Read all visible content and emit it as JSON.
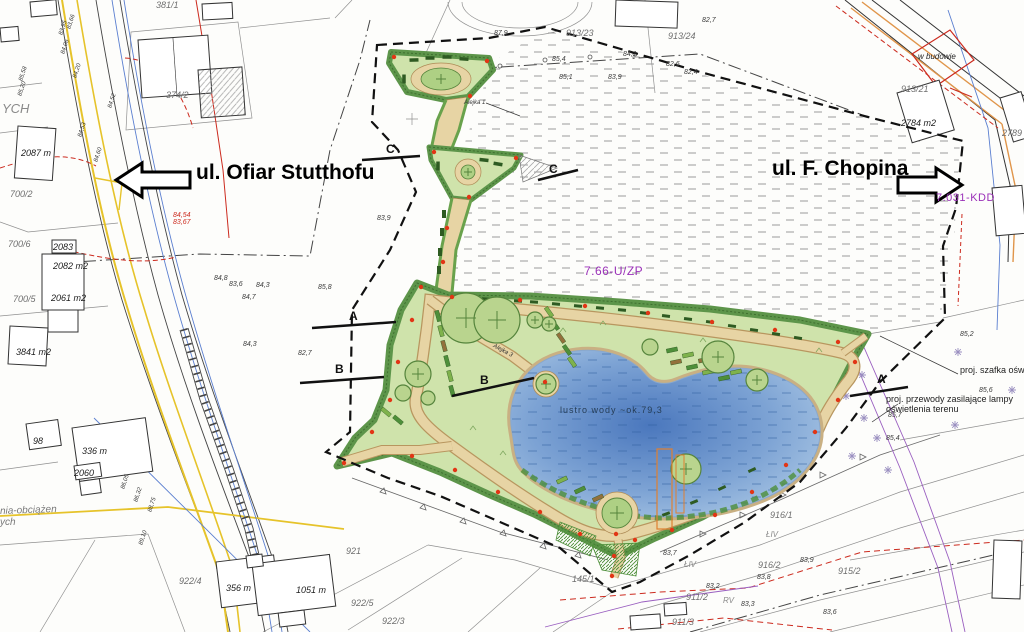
{
  "meta": {
    "type": "landscape-site-plan"
  },
  "streets": {
    "left": {
      "label": "ul. Ofiar Stutthofu"
    },
    "right": {
      "label": "ul. F. Chopina"
    }
  },
  "zones": {
    "park": "7.66-U/ZP",
    "road": "7.031-KDD"
  },
  "pond": {
    "label": "lustro wody ~ok.79,3"
  },
  "annotations": {
    "cabinet": "proj. szafka oświetl",
    "cables1": "proj. przewody zasilające lampy",
    "cables2": "oświetlenia terenu",
    "under_construction": "w budowie",
    "edge_top": "YCH",
    "edge_bottom1": "nia-obciążen",
    "edge_bottom2": "ych",
    "alejka1": "Alejka 1",
    "alejka3": "Alejka 3"
  },
  "section_markers": [
    {
      "label": "A"
    },
    {
      "label": "B"
    },
    {
      "label": "C"
    },
    {
      "label": "C"
    },
    {
      "label": "B"
    },
    {
      "label": "A"
    }
  ],
  "parcels": [
    {
      "label": "700/6"
    },
    {
      "label": "700/5"
    },
    {
      "label": "700/2"
    },
    {
      "label": "374/2"
    },
    {
      "label": "381/1"
    },
    {
      "label": "913/23"
    },
    {
      "label": "913/24"
    },
    {
      "label": "913/21"
    },
    {
      "label": "921"
    },
    {
      "label": "922/5"
    },
    {
      "label": "922/3"
    },
    {
      "label": "922/4"
    },
    {
      "label": "916/1"
    },
    {
      "label": "916/2"
    },
    {
      "label": "915/2"
    },
    {
      "label": "911/2"
    },
    {
      "label": "911/3"
    },
    {
      "label": "145/1"
    },
    {
      "label": "2789"
    }
  ],
  "buildings": [
    {
      "label": "2087 m"
    },
    {
      "label": "2083"
    },
    {
      "label": "2082 m2"
    },
    {
      "label": "2061 m2"
    },
    {
      "label": "3841 m2"
    },
    {
      "label": "98"
    },
    {
      "label": "336 m"
    },
    {
      "label": "2060"
    },
    {
      "label": "356 m"
    },
    {
      "label": "1051 m"
    },
    {
      "label": "2784 m2"
    }
  ],
  "elevations": [
    {
      "label": "87,9"
    },
    {
      "label": "85,4"
    },
    {
      "label": "84,1"
    },
    {
      "label": "82,7"
    },
    {
      "label": "82,6"
    },
    {
      "label": "82,4"
    },
    {
      "label": "83,9"
    },
    {
      "label": "85,1"
    },
    {
      "label": "83,9"
    },
    {
      "label": "84,8"
    },
    {
      "label": "83,6"
    },
    {
      "label": "84,3"
    },
    {
      "label": "84,7"
    },
    {
      "label": "85,8"
    },
    {
      "label": "84,3"
    },
    {
      "label": "82,7"
    },
    {
      "label": "85,2"
    },
    {
      "label": "85,6"
    },
    {
      "label": "85,7"
    },
    {
      "label": "85,4"
    },
    {
      "label": "83,7"
    },
    {
      "label": "83,9"
    },
    {
      "label": "83,8"
    },
    {
      "label": "83,2"
    },
    {
      "label": "83,3"
    },
    {
      "label": "83,6"
    }
  ],
  "road_elevations": [
    {
      "label": "83,66"
    },
    {
      "label": "83,95"
    },
    {
      "label": "84,06"
    },
    {
      "label": "84,20"
    },
    {
      "label": "84,52"
    },
    {
      "label": "84,53"
    },
    {
      "label": "84,60"
    },
    {
      "label": "85,58"
    },
    {
      "label": "85,20"
    },
    {
      "label": "86,05"
    },
    {
      "label": "86,32"
    },
    {
      "label": "88,75"
    },
    {
      "label": "89,10"
    }
  ],
  "red_marks": [
    {
      "label": "84,54"
    },
    {
      "label": "83,67"
    }
  ],
  "land_class": [
    {
      "label": "ŁIV"
    },
    {
      "label": "ŁIV"
    },
    {
      "label": "RV"
    }
  ],
  "colors": {
    "lawn": "#cfe3ab",
    "hedge": "#5d954a",
    "path_tan": "#e7d4a4",
    "path_edge": "#ad8a55",
    "pond_deep": "#4a77bd",
    "pond_light": "#a9c6e4",
    "lamp_red": "#e23515",
    "bench": "#2e5b22",
    "utility_yellow": "#e6c32a",
    "utility_blue": "#5b7fd0",
    "utility_red": "#cc2a1e",
    "utility_orange": "#e0954a",
    "cable_violet": "#9a5fc0",
    "zone_purple": "#9a30b8",
    "boundary": "#111111"
  }
}
